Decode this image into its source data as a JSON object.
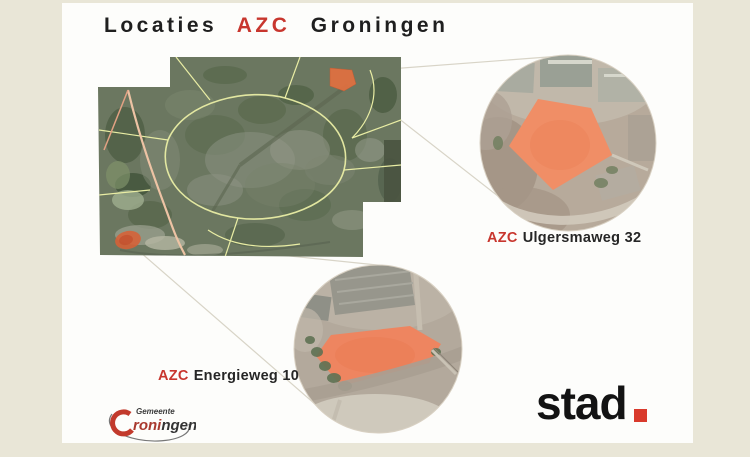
{
  "page": {
    "background_beige": "#e9e6d7",
    "slide_background": "#fdfdfb"
  },
  "title": {
    "word1": "Locaties",
    "word2": "AZC",
    "word3": "Groningen"
  },
  "labels": {
    "ulgersmaweg": {
      "prefix": "AZC",
      "name": "Ulgersmaweg 32"
    },
    "energieweg": {
      "prefix": "AZC",
      "name": "Energieweg 10"
    }
  },
  "map": {
    "kind": "satellite-overview-with-two-callout-circles",
    "site_highlight_color": "#ee8560"
  },
  "gemeente_logo": {
    "subtitle": "Gemeente",
    "name_red": "roni",
    "name_dark": "ngen"
  },
  "stad_logo": {
    "text": "stad"
  },
  "colors": {
    "accent_red": "#c8362e",
    "site_orange": "#ee8560",
    "connector_line": "#d8d4c7"
  }
}
